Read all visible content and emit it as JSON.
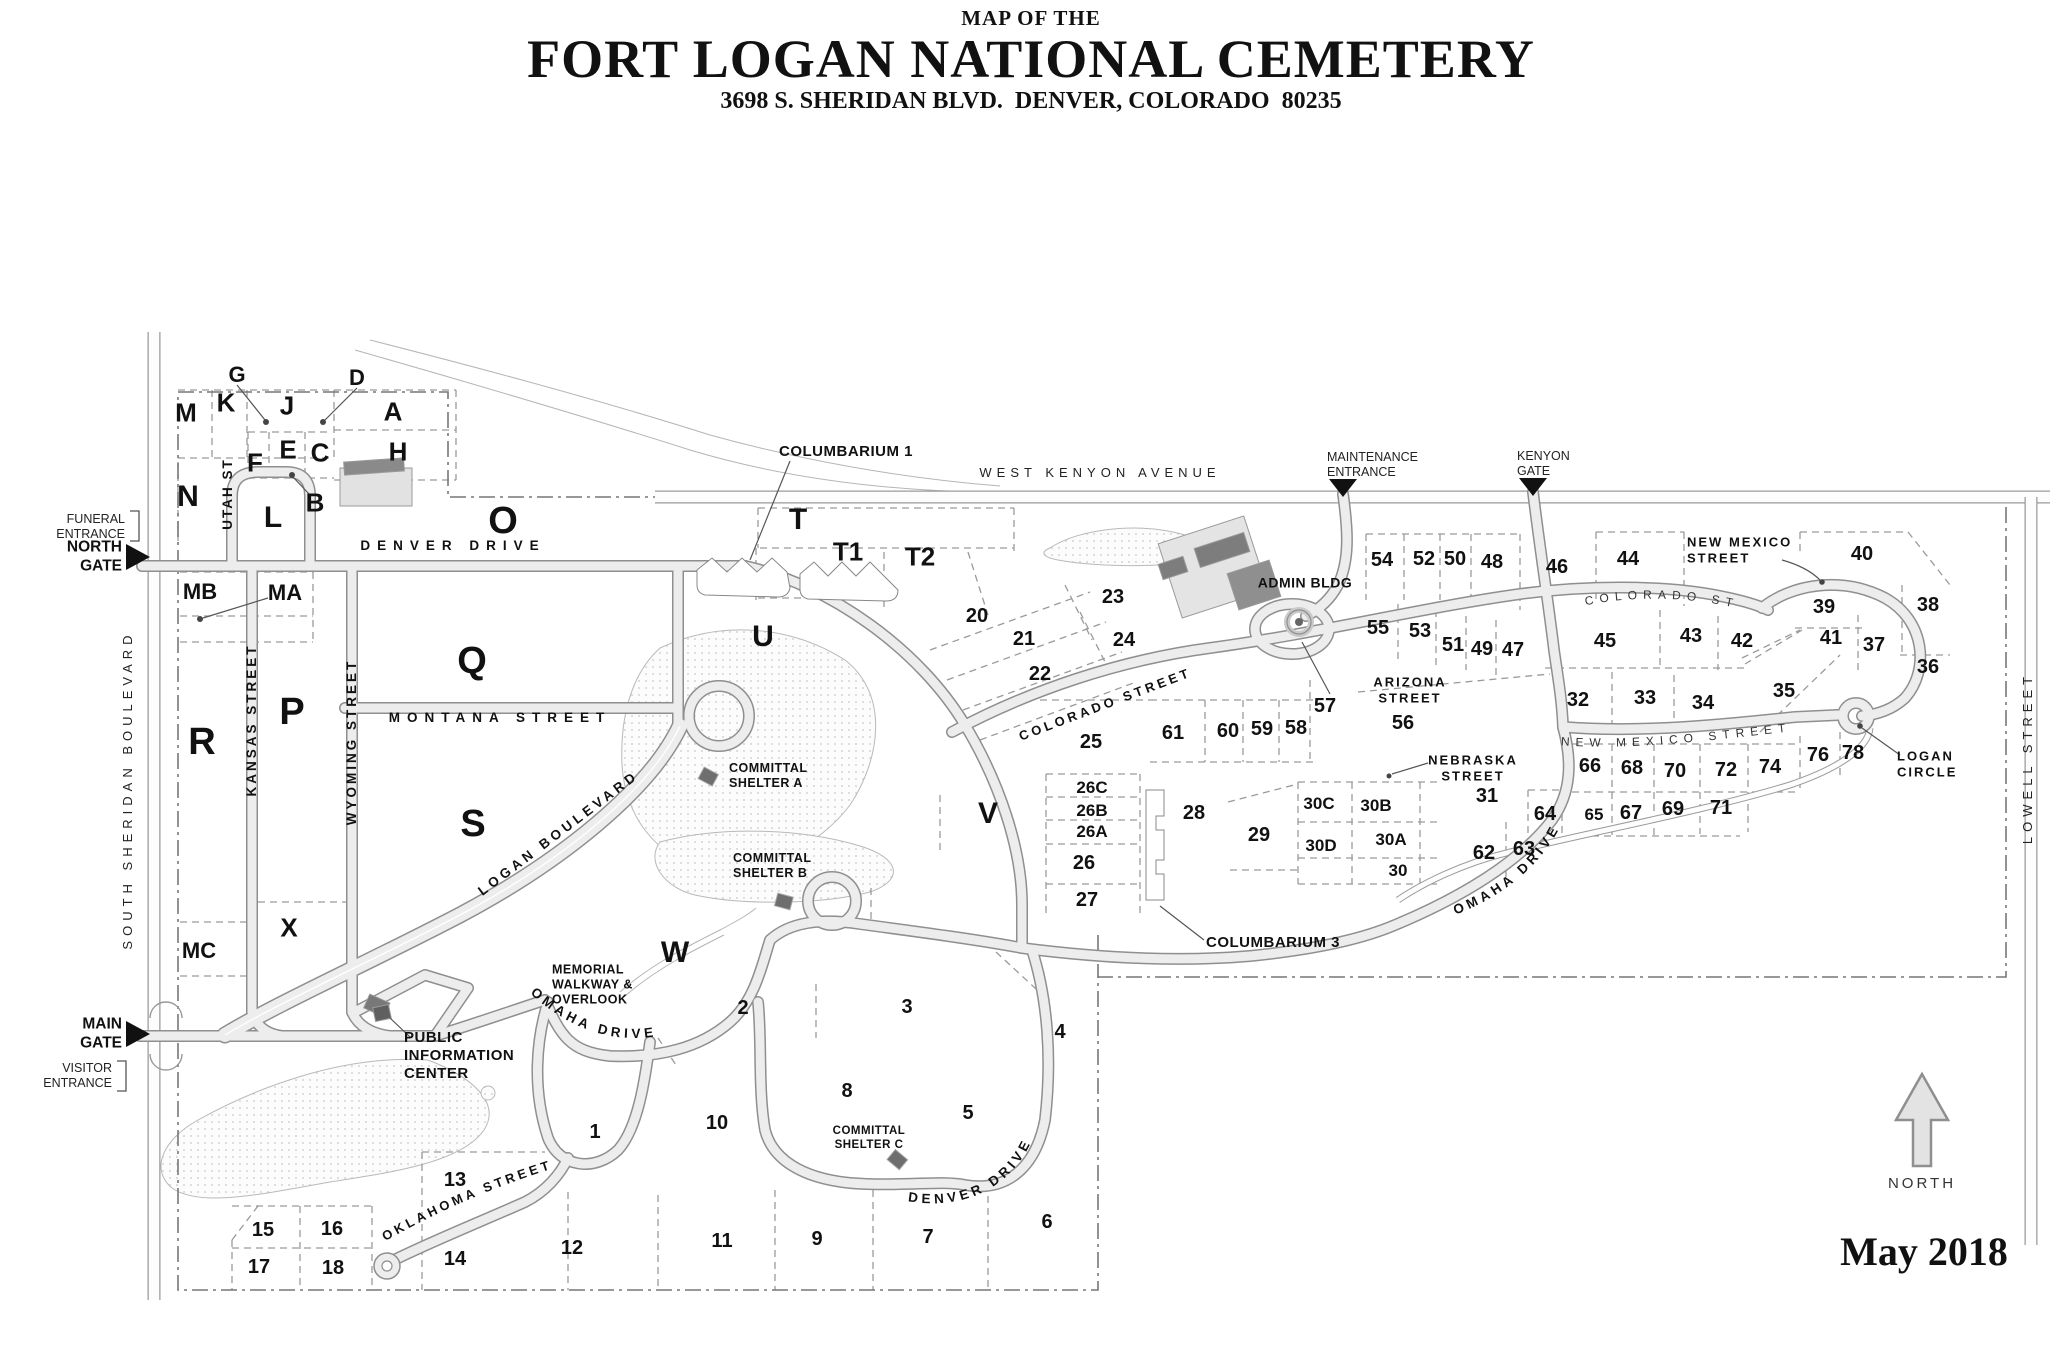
{
  "header": {
    "pretitle": "MAP OF THE",
    "title": "FORT LOGAN NATIONAL CEMETERY",
    "address": "3698 S. SHERIDAN BLVD.  DENVER, COLORADO  80235"
  },
  "legend": {
    "date": "May 2018",
    "north": "NORTH"
  },
  "entrances": {
    "funeral": "FUNERAL\nENTRANCE",
    "north_gate": "NORTH\nGATE",
    "main_gate": "MAIN\nGATE",
    "visitor": "VISITOR\nENTRANCE",
    "maintenance": "MAINTENANCE\nENTRANCE",
    "kenyon": "KENYON\nGATE"
  },
  "streets": {
    "west_kenyon": "WEST KENYON AVENUE",
    "denver_drive": "DENVER DRIVE",
    "montana": "MONTANA STREET",
    "utah": "UTAH ST",
    "kansas": "KANSAS STREET",
    "wyoming": "WYOMING STREET",
    "sheridan": "SOUTH SHERIDAN BOULEVARD",
    "lowell": "LOWELL STREET",
    "logan_blvd": "LOGAN BOULEVARD",
    "omaha_west": "OMAHA DRIVE",
    "omaha_east": "OMAHA DRIVE",
    "denver_drive_south": "DENVER DRIVE",
    "oklahoma": "OKLAHOMA STREET",
    "colorado_mid": "COLORADO STREET",
    "colorado_upper": "COLORADO ST",
    "arizona": "ARIZONA\nSTREET",
    "nebraska": "NEBRASKA\nSTREET",
    "new_mexico_label": "NEW MEXICO\nSTREET",
    "new_mexico_curved": "NEW MEXICO STREET"
  },
  "places": {
    "admin": "ADMIN BLDG",
    "columbarium1": "COLUMBARIUM 1",
    "columbarium3": "COLUMBARIUM 3",
    "shelter_a": "COMMITTAL\nSHELTER A",
    "shelter_b": "COMMITTAL\nSHELTER B",
    "shelter_c": "COMMITTAL\nSHELTER C",
    "info_center": "PUBLIC\nINFORMATION\nCENTER",
    "memorial_walkway": "MEMORIAL\nWALKWAY &\nOVERLOOK",
    "logan_circle": "LOGAN\nCIRCLE"
  },
  "sections": {
    "letters": {
      "A": "A",
      "B": "B",
      "C": "C",
      "D": "D",
      "E": "E",
      "F": "F",
      "G": "G",
      "H": "H",
      "J": "J",
      "K": "K",
      "L": "L",
      "M": "M",
      "N": "N",
      "O": "O",
      "P": "P",
      "Q": "Q",
      "R": "R",
      "S": "S",
      "T": "T",
      "T1": "T1",
      "T2": "T2",
      "U": "U",
      "V": "V",
      "W": "W",
      "X": "X",
      "MA": "MA",
      "MB": "MB",
      "MC": "MC"
    },
    "numbers": {
      "1": "1",
      "2": "2",
      "3": "3",
      "4": "4",
      "5": "5",
      "6": "6",
      "7": "7",
      "8": "8",
      "9": "9",
      "10": "10",
      "11": "11",
      "12": "12",
      "13": "13",
      "14": "14",
      "15": "15",
      "16": "16",
      "17": "17",
      "18": "18",
      "20": "20",
      "21": "21",
      "22": "22",
      "23": "23",
      "24": "24",
      "25": "25",
      "26": "26",
      "26A": "26A",
      "26B": "26B",
      "26C": "26C",
      "27": "27",
      "28": "28",
      "29": "29",
      "30": "30",
      "30A": "30A",
      "30B": "30B",
      "30C": "30C",
      "30D": "30D",
      "31": "31",
      "32": "32",
      "33": "33",
      "34": "34",
      "35": "35",
      "36": "36",
      "37": "37",
      "38": "38",
      "39": "39",
      "40": "40",
      "41": "41",
      "42": "42",
      "43": "43",
      "44": "44",
      "45": "45",
      "46": "46",
      "47": "47",
      "48": "48",
      "49": "49",
      "50": "50",
      "51": "51",
      "52": "52",
      "53": "53",
      "54": "54",
      "55": "55",
      "56": "56",
      "57": "57",
      "58": "58",
      "59": "59",
      "60": "60",
      "61": "61",
      "62": "62",
      "63": "63",
      "64": "64",
      "65": "65",
      "66": "66",
      "67": "67",
      "68": "68",
      "69": "69",
      "70": "70",
      "71": "71",
      "72": "72",
      "74": "74",
      "76": "76",
      "78": "78"
    }
  }
}
